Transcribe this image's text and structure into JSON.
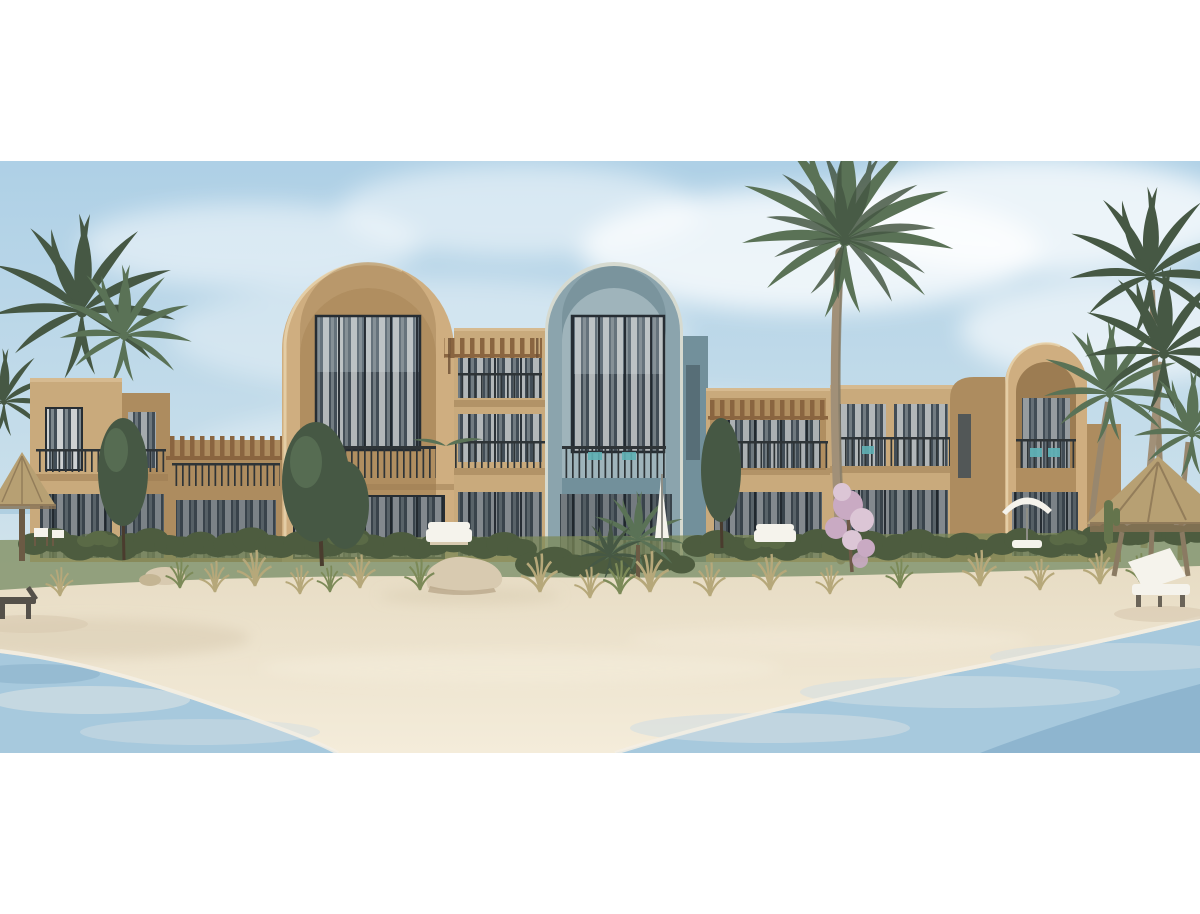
{
  "image": {
    "type": "architectural-rendering",
    "subject": "Beachfront two-storey resort apartment complex with large arched facades, palm trees, sandy beach and lagoon water in the foreground",
    "style": "photorealistic CGI render, white letterbox margins above and below"
  },
  "palette": {
    "sky_top": "#aed0e6",
    "sky_mid": "#c9dfeb",
    "sky_low": "#e3ecec",
    "cloud": "#ffffff",
    "tan": "#c9aa7c",
    "tan_light": "#d6ba90",
    "tan_shade": "#ad8c5f",
    "tan_dark": "#9c7c52",
    "arch_tan": "#cfae80",
    "arch_recess": "#b08e60",
    "arch_blue": "#8ba4ad",
    "arch_blue_shade": "#72909b",
    "arch_blue_recess": "#9fb4bb",
    "arch_blue_rim": "#d6dad0",
    "window_glass": "#424d56",
    "door_glass": "#39434b",
    "window_frame": "#262d33",
    "curtain": "#e6e9e8",
    "railing": "#2e3437",
    "pergola_wood": "#8a6540",
    "hedge": "#4d5c3f",
    "hedge_light": "#64744c",
    "grass_green": "#7c8a58",
    "grass_dry": "#b6a87a",
    "palm_green": "#5a7256",
    "palm_dark": "#465844",
    "palm_trunk": "#a19078",
    "sand": "#ece1cb",
    "sand_highlight": "#f4ecda",
    "sand_shadow": "#d8cab0",
    "water": "#a7c9dd",
    "water_deep": "#8ab2cc",
    "water_pale": "#d2dee3",
    "foam": "#f3efe4",
    "thatch": "#b7a073",
    "thatch_dark": "#887356",
    "white_furniture": "#f5f3ec",
    "dark_wood": "#55514a",
    "pink_blossom": "#c9aac3",
    "pink_blossom_light": "#dcc6d6",
    "teal_accent": "#5fb0b5"
  },
  "scene": {
    "objects": [
      "sky with soft white clouds",
      "tan arched tower with double-height curtained window and balcony",
      "blue-gray arched tower with double-height curtained window and balcony",
      "smaller tan arched tower with recessed balcony niche",
      "flat-roofed tan wings with wooden pergolas and balcony railings",
      "ground-floor glass sliding doors with white curtains",
      "tall center palm tree in front of the facade",
      "palm clusters at left and right",
      "two slender dark green trees",
      "pink flowering shrub",
      "hedge row and dry beach grass",
      "thatched palapa umbrellas at left edge and right side",
      "white double sun lounger and wooden lounger on the sand",
      "white parasols",
      "beige rocks on the sand",
      "wide sandy beach",
      "lagoon water in lower-left and lower-right corners"
    ]
  }
}
